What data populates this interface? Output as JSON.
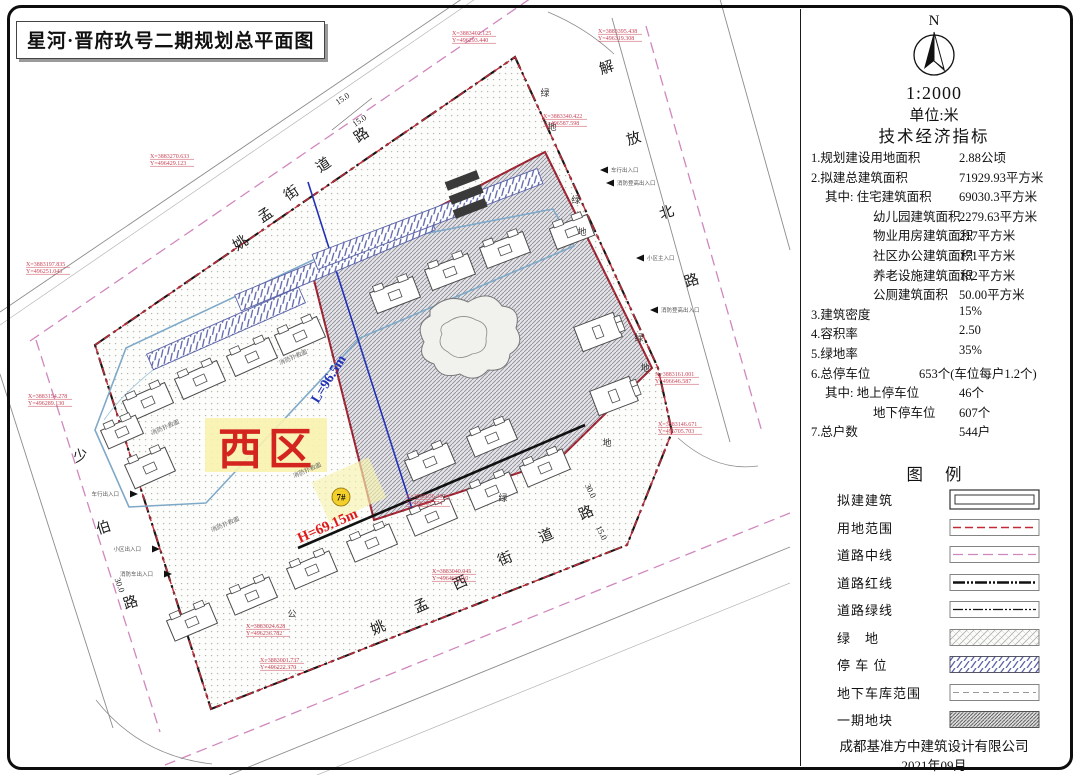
{
  "title": "星河·晋府玖号二期规划总平面图",
  "colors": {
    "boundary_red": "#c22a38",
    "road_center_pink": "#d087be",
    "parking_blue": "#5a63a8",
    "zone_red": "#d42420",
    "measure_blue": "#2230b8",
    "height_red": "#e01818",
    "badge_yellow": "#f2cf2a"
  },
  "map": {
    "zone_label": "西区",
    "length_label": "L=96.5m",
    "height_label": "H=69.15m",
    "building_badge": "7#",
    "roads": [
      {
        "id": "yaomeng-street",
        "name": "姚孟街道路",
        "angle": -34,
        "chars": [
          {
            "c": "姚",
            "x": 243,
            "y": 247
          },
          {
            "c": "孟",
            "x": 268,
            "y": 219
          },
          {
            "c": "街",
            "x": 294,
            "y": 197
          },
          {
            "c": "道",
            "x": 326,
            "y": 169
          },
          {
            "c": "路",
            "x": 364,
            "y": 139
          }
        ]
      },
      {
        "id": "jiefang-north-road",
        "name": "解放北路",
        "angle": -18,
        "chars": [
          {
            "c": "解",
            "x": 608,
            "y": 72
          },
          {
            "c": "放",
            "x": 635,
            "y": 143
          },
          {
            "c": "北",
            "x": 668,
            "y": 217
          },
          {
            "c": "路",
            "x": 693,
            "y": 285
          }
        ]
      },
      {
        "id": "shaobo-road",
        "name": "少伯路",
        "angle": -18,
        "chars": [
          {
            "c": "少",
            "x": 82,
            "y": 460
          },
          {
            "c": "伯",
            "x": 105,
            "y": 532
          },
          {
            "c": "路",
            "x": 132,
            "y": 607
          }
        ]
      },
      {
        "id": "yaomeng-west-street",
        "name": "姚孟西街道路",
        "angle": -24,
        "chars": [
          {
            "c": "姚",
            "x": 380,
            "y": 632
          },
          {
            "c": "孟",
            "x": 423,
            "y": 610
          },
          {
            "c": "西",
            "x": 462,
            "y": 587
          },
          {
            "c": "街",
            "x": 507,
            "y": 563
          },
          {
            "c": "道",
            "x": 548,
            "y": 540
          },
          {
            "c": "路",
            "x": 588,
            "y": 517
          }
        ]
      }
    ],
    "green_chars": [
      {
        "c": "绿",
        "x": 545,
        "y": 96
      },
      {
        "c": "地",
        "x": 552,
        "y": 130
      },
      {
        "c": "绿",
        "x": 576,
        "y": 203
      },
      {
        "c": "地",
        "x": 582,
        "y": 235
      },
      {
        "c": "绿",
        "x": 639,
        "y": 341
      },
      {
        "c": "地",
        "x": 645,
        "y": 371
      },
      {
        "c": "公",
        "x": 292,
        "y": 617
      },
      {
        "c": "绿",
        "x": 503,
        "y": 501
      },
      {
        "c": "地",
        "x": 607,
        "y": 446
      }
    ],
    "dim_labels": [
      {
        "t": "15.0",
        "x": 344,
        "y": 101,
        "r": -34
      },
      {
        "t": "15.0",
        "x": 361,
        "y": 123,
        "r": -34
      },
      {
        "t": "30.0",
        "x": 117,
        "y": 586,
        "r": 70
      },
      {
        "t": "30.0",
        "x": 588,
        "y": 492,
        "r": 64
      },
      {
        "t": "15.0",
        "x": 599,
        "y": 534,
        "r": 64
      }
    ],
    "fire_labels": [
      {
        "t": "消防扑救面",
        "x": 308,
        "y": 472,
        "r": -23
      },
      {
        "t": "消防扑救面",
        "x": 226,
        "y": 526,
        "r": -23
      },
      {
        "t": "消防扑救面",
        "x": 294,
        "y": 359,
        "r": -23
      },
      {
        "t": "消防扑救面",
        "x": 166,
        "y": 429,
        "r": -23
      }
    ],
    "entrances": [
      {
        "t": "车行出入口",
        "x": 600,
        "y": 170,
        "side": "right"
      },
      {
        "t": "消防登高出入口",
        "x": 606,
        "y": 183,
        "side": "right"
      },
      {
        "t": "小区主入口",
        "x": 636,
        "y": 258,
        "side": "right"
      },
      {
        "t": "消防登高出入口",
        "x": 650,
        "y": 310,
        "side": "right"
      },
      {
        "t": "车行出入口",
        "x": 130,
        "y": 494,
        "side": "left"
      },
      {
        "t": "小区出入口",
        "x": 152,
        "y": 549,
        "side": "left"
      },
      {
        "t": "消防车出入口",
        "x": 164,
        "y": 574,
        "side": "left"
      }
    ],
    "coord_markers": [
      {
        "x": 452,
        "y": 35,
        "lines": [
          "X=3883402.125",
          "Y=496293.440"
        ]
      },
      {
        "x": 598,
        "y": 33,
        "lines": [
          "X=3883395.438",
          "Y=496319.308"
        ]
      },
      {
        "x": 543,
        "y": 118,
        "lines": [
          "X=3883340.422",
          "Y=496587.598"
        ]
      },
      {
        "x": 655,
        "y": 376,
        "lines": [
          "X=3883161.001",
          "Y=496646.587"
        ]
      },
      {
        "x": 658,
        "y": 426,
        "lines": [
          "X=3883146.671",
          "Y=496705.703"
        ]
      },
      {
        "x": 26,
        "y": 266,
        "lines": [
          "X=3883197.835",
          "Y=496251.043"
        ]
      },
      {
        "x": 28,
        "y": 398,
        "lines": [
          "X=3883154.278",
          "Y=496289.130"
        ]
      },
      {
        "x": 150,
        "y": 158,
        "lines": [
          "X=3883270.633",
          "Y=496429.123"
        ]
      },
      {
        "x": 246,
        "y": 628,
        "lines": [
          "X=3883024.628",
          "Y=496236.782"
        ]
      },
      {
        "x": 260,
        "y": 662,
        "lines": [
          "X=3883001.737",
          "Y=496222.370"
        ]
      },
      {
        "x": 406,
        "y": 498,
        "lines": [
          "X=3883036.467",
          "Y=496487.774"
        ]
      },
      {
        "x": 432,
        "y": 573,
        "lines": [
          "X=3883040.045",
          "Y=496463.710"
        ]
      }
    ]
  },
  "panel": {
    "north_label": "N",
    "scale": "1:2000",
    "unit": "单位:米",
    "indicators_title": "技术经济指标",
    "indicators": [
      {
        "label": "1.规划建设用地面积",
        "value": "2.88公顷",
        "indent": 0,
        "wide": false
      },
      {
        "label": "2.拟建总建筑面积",
        "value": "71929.93平方米",
        "indent": 0,
        "wide": false
      },
      {
        "label": "其中: 住宅建筑面积",
        "value": "69030.3平方米",
        "indent": 1,
        "wide": false
      },
      {
        "label": "幼儿园建筑面积",
        "value": "2279.63平方米",
        "indent": 2,
        "wide": false
      },
      {
        "label": "物业用房建筑面积",
        "value": "217平方米",
        "indent": 2,
        "wide": false
      },
      {
        "label": "社区办公建筑面积",
        "value": "171平方米",
        "indent": 2,
        "wide": false
      },
      {
        "label": "养老设施建筑面积",
        "value": "182平方米",
        "indent": 2,
        "wide": false
      },
      {
        "label": "公厕建筑面积",
        "value": "50.00平方米",
        "indent": 2,
        "wide": false
      },
      {
        "label": "3.建筑密度",
        "value": "15%",
        "indent": 0,
        "wide": false
      },
      {
        "label": "4.容积率",
        "value": "2.50",
        "indent": 0,
        "wide": false
      },
      {
        "label": "5.绿地率",
        "value": "35%",
        "indent": 0,
        "wide": false
      },
      {
        "label": "6.总停车位",
        "value": "653个(车位每户1.2个)",
        "indent": 0,
        "wide": true
      },
      {
        "label": "其中: 地上停车位",
        "value": "46个",
        "indent": 1,
        "wide": false
      },
      {
        "label": "地下停车位",
        "value": "607个",
        "indent": 2,
        "wide": false
      },
      {
        "label": "7.总户数",
        "value": "544户",
        "indent": 0,
        "wide": false
      }
    ],
    "legend_title": "图例",
    "legend": [
      {
        "label": "拟建建筑",
        "type": "building"
      },
      {
        "label": "用地范围",
        "type": "site-boundary"
      },
      {
        "label": "道路中线",
        "type": "road-center"
      },
      {
        "label": "道路红线",
        "type": "road-red"
      },
      {
        "label": "道路绿线",
        "type": "road-green"
      },
      {
        "label": "绿　地",
        "type": "green-space"
      },
      {
        "label": "停 车 位",
        "type": "parking"
      },
      {
        "label": "地下车库范围",
        "type": "garage"
      },
      {
        "label": "一期地块",
        "type": "phase1"
      }
    ],
    "company": "成都基准方中建筑设计有限公司",
    "date": "2021年09月"
  }
}
